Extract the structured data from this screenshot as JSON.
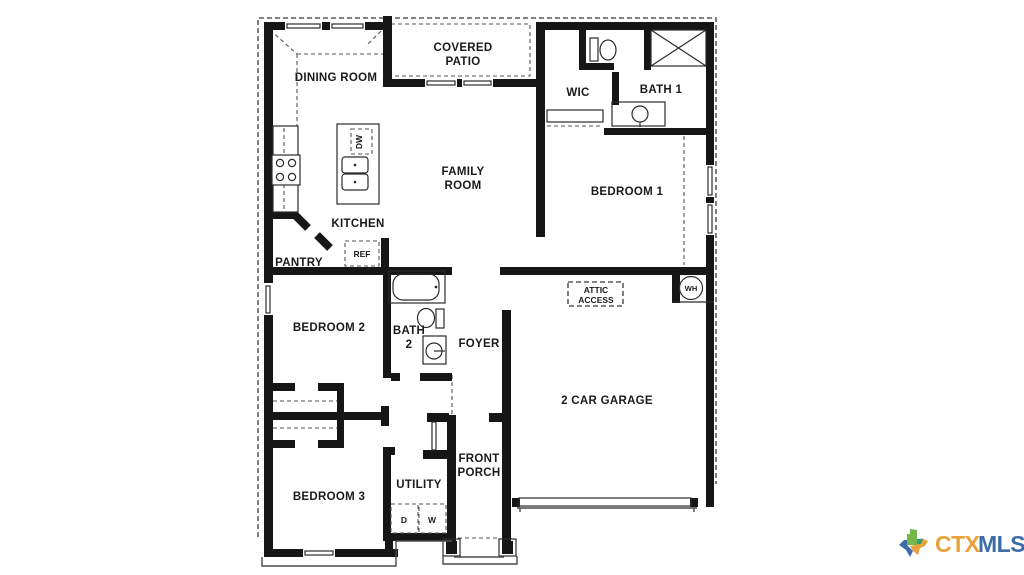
{
  "plan": {
    "rooms": {
      "dining": "DINING ROOM",
      "covered_patio_line1": "COVERED",
      "covered_patio_line2": "PATIO",
      "wic": "WIC",
      "bath1": "BATH 1",
      "family_line1": "FAMILY",
      "family_line2": "ROOM",
      "bedroom1": "BEDROOM 1",
      "kitchen": "KITCHEN",
      "pantry": "PANTRY",
      "bedroom2": "BEDROOM 2",
      "bath2_line1": "BATH",
      "bath2_line2": "2",
      "foyer": "FOYER",
      "garage": "2 CAR GARAGE",
      "bedroom3": "BEDROOM 3",
      "utility": "UTILITY",
      "porch_line1": "FRONT",
      "porch_line2": "PORCH",
      "attic_line1": "ATTIC",
      "attic_line2": "ACCESS"
    },
    "appliances": {
      "ref": "REF",
      "dw": "DW",
      "wh": "WH",
      "dryer": "D",
      "washer": "W"
    }
  },
  "logo": {
    "ctx": "CTX",
    "mls": "MLS"
  },
  "colors": {
    "wall": "#161616",
    "label": "#1a1a1a",
    "logo_orange": "#E9A13B",
    "logo_blue": "#3D6CA8",
    "logo_green": "#74B74A",
    "logo_teal": "#2E9E77"
  }
}
